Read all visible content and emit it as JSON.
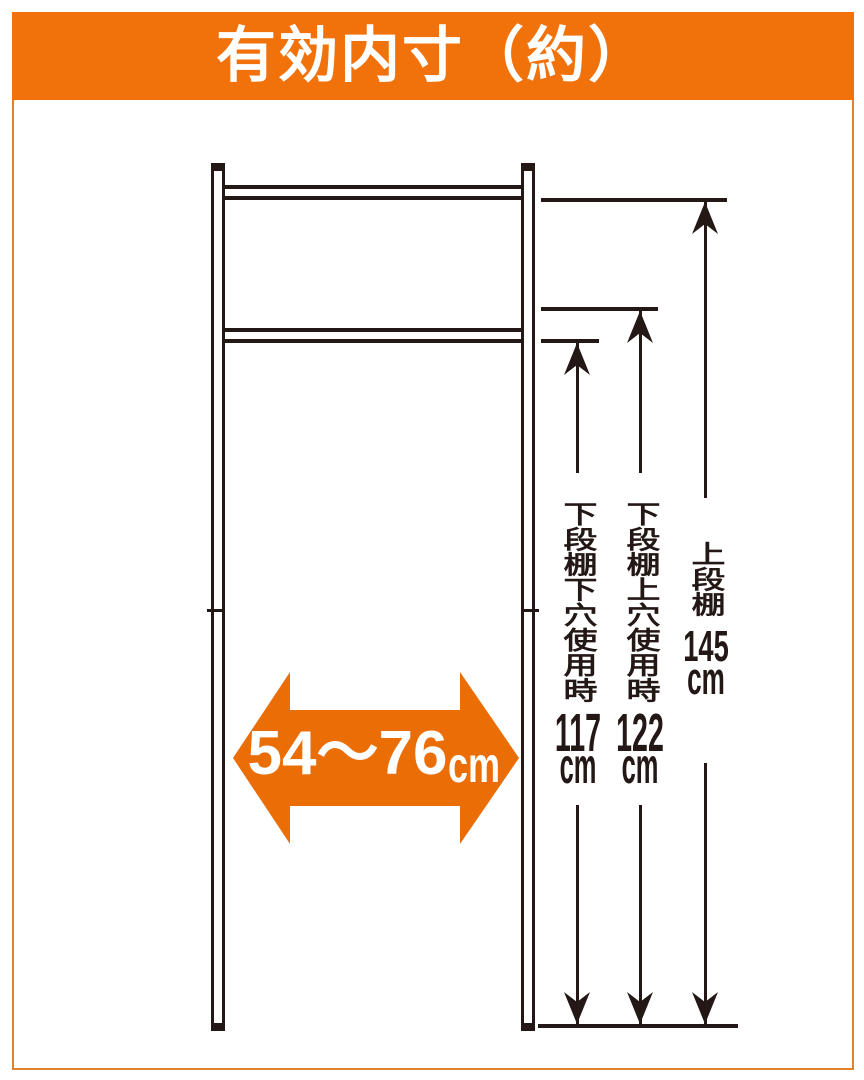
{
  "header": {
    "title": "有効内寸（約）"
  },
  "width_dimension": {
    "value": "54～76",
    "unit": "cm"
  },
  "height_dimensions": [
    {
      "label": "下段棚下穴使用時",
      "value": "117",
      "unit": "cm"
    },
    {
      "label": "下段棚上穴使用時",
      "value": "122",
      "unit": "cm"
    },
    {
      "label": "上段棚",
      "value": "145",
      "unit": "cm"
    }
  ],
  "colors": {
    "header_orange": "#F1720B",
    "arrow_orange": "#EB6D06",
    "ink": "#231815",
    "frame_border": "#E0832F"
  }
}
